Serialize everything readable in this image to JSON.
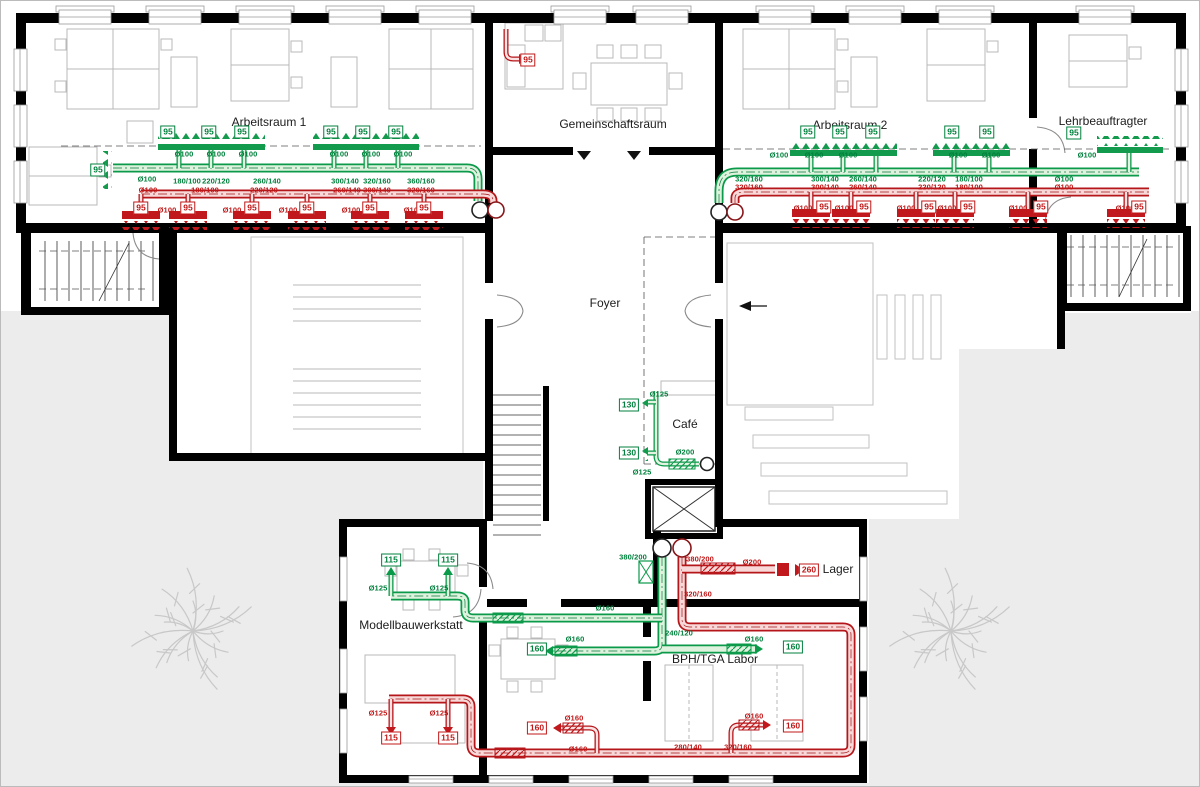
{
  "drawing": {
    "rooms": {
      "arbeitsraum_1": "Arbeitsraum 1",
      "gemeinschaftsraum": "Gemeinschaftsraum",
      "arbeitsraum_2": "Arbeitsraum 2",
      "lehrbeauftragter": "Lehrbeauftragter",
      "foyer": "Foyer",
      "cafe": "Café",
      "modellbauwerkstatt": "Modellbauwerkstatt",
      "bph_tga_labor": "BPH/TGA Labor",
      "lager": "Lager"
    },
    "colors": {
      "supply_duct": "#0b9a4a",
      "exhaust_duct": "#b5161a",
      "wall": "#000000",
      "ground": "#ececec",
      "furniture": "#b9b9b9"
    },
    "flow_badges": {
      "supply": [
        {
          "v": "95",
          "x": 97,
          "y": 169
        },
        {
          "v": "95",
          "x": 167,
          "y": 131
        },
        {
          "v": "95",
          "x": 208,
          "y": 131
        },
        {
          "v": "95",
          "x": 241,
          "y": 131
        },
        {
          "v": "95",
          "x": 330,
          "y": 131
        },
        {
          "v": "95",
          "x": 362,
          "y": 131
        },
        {
          "v": "95",
          "x": 395,
          "y": 131
        },
        {
          "v": "95",
          "x": 807,
          "y": 131
        },
        {
          "v": "95",
          "x": 839,
          "y": 131
        },
        {
          "v": "95",
          "x": 872,
          "y": 131
        },
        {
          "v": "95",
          "x": 951,
          "y": 131
        },
        {
          "v": "95",
          "x": 986,
          "y": 131
        },
        {
          "v": "95",
          "x": 1073,
          "y": 132
        },
        {
          "v": "130",
          "x": 628,
          "y": 404
        },
        {
          "v": "130",
          "x": 628,
          "y": 452
        },
        {
          "v": "115",
          "x": 390,
          "y": 559
        },
        {
          "v": "115",
          "x": 447,
          "y": 559
        },
        {
          "v": "160",
          "x": 536,
          "y": 648
        },
        {
          "v": "160",
          "x": 792,
          "y": 646
        }
      ],
      "exhaust": [
        {
          "v": "95",
          "x": 140,
          "y": 207
        },
        {
          "v": "95",
          "x": 187,
          "y": 207
        },
        {
          "v": "95",
          "x": 251,
          "y": 207
        },
        {
          "v": "95",
          "x": 306,
          "y": 207
        },
        {
          "v": "95",
          "x": 369,
          "y": 207
        },
        {
          "v": "95",
          "x": 423,
          "y": 207
        },
        {
          "v": "95",
          "x": 823,
          "y": 206
        },
        {
          "v": "95",
          "x": 863,
          "y": 206
        },
        {
          "v": "95",
          "x": 928,
          "y": 206
        },
        {
          "v": "95",
          "x": 967,
          "y": 206
        },
        {
          "v": "95",
          "x": 1040,
          "y": 206
        },
        {
          "v": "95",
          "x": 1138,
          "y": 206
        },
        {
          "v": "95",
          "x": 527,
          "y": 59
        },
        {
          "v": "115",
          "x": 390,
          "y": 737
        },
        {
          "v": "115",
          "x": 447,
          "y": 737
        },
        {
          "v": "160",
          "x": 536,
          "y": 727
        },
        {
          "v": "160",
          "x": 792,
          "y": 725
        },
        {
          "v": "260",
          "x": 808,
          "y": 569
        }
      ]
    },
    "duct_labels": {
      "supply": [
        {
          "t": "Ø100",
          "x": 183,
          "y": 153
        },
        {
          "t": "Ø100",
          "x": 215,
          "y": 153
        },
        {
          "t": "Ø100",
          "x": 247,
          "y": 153
        },
        {
          "t": "Ø100",
          "x": 338,
          "y": 153
        },
        {
          "t": "Ø100",
          "x": 370,
          "y": 153
        },
        {
          "t": "Ø100",
          "x": 402,
          "y": 153
        },
        {
          "t": "Ø100",
          "x": 146,
          "y": 178
        },
        {
          "t": "180/100",
          "x": 186,
          "y": 180
        },
        {
          "t": "220/120",
          "x": 215,
          "y": 180
        },
        {
          "t": "260/140",
          "x": 266,
          "y": 180
        },
        {
          "t": "300/140",
          "x": 344,
          "y": 180
        },
        {
          "t": "320/160",
          "x": 376,
          "y": 180
        },
        {
          "t": "360/160",
          "x": 420,
          "y": 180
        },
        {
          "t": "320/160",
          "x": 748,
          "y": 178
        },
        {
          "t": "300/140",
          "x": 824,
          "y": 178
        },
        {
          "t": "260/140",
          "x": 862,
          "y": 178
        },
        {
          "t": "220/120",
          "x": 931,
          "y": 178
        },
        {
          "t": "180/100",
          "x": 968,
          "y": 178
        },
        {
          "t": "Ø100",
          "x": 1063,
          "y": 178
        },
        {
          "t": "Ø100",
          "x": 778,
          "y": 154
        },
        {
          "t": "Ø100",
          "x": 813,
          "y": 154
        },
        {
          "t": "Ø100",
          "x": 847,
          "y": 154
        },
        {
          "t": "Ø100",
          "x": 957,
          "y": 154
        },
        {
          "t": "Ø100",
          "x": 990,
          "y": 154
        },
        {
          "t": "Ø100",
          "x": 1086,
          "y": 154
        },
        {
          "t": "Ø125",
          "x": 658,
          "y": 393
        },
        {
          "t": "Ø125",
          "x": 641,
          "y": 471
        },
        {
          "t": "Ø200",
          "x": 684,
          "y": 451
        },
        {
          "t": "380/200",
          "x": 632,
          "y": 556
        },
        {
          "t": "Ø125",
          "x": 377,
          "y": 587
        },
        {
          "t": "Ø125",
          "x": 438,
          "y": 587
        },
        {
          "t": "Ø160",
          "x": 604,
          "y": 607
        },
        {
          "t": "Ø160",
          "x": 574,
          "y": 638
        },
        {
          "t": "Ø160",
          "x": 753,
          "y": 638
        },
        {
          "t": "240/120",
          "x": 678,
          "y": 632
        }
      ],
      "exhaust": [
        {
          "t": "Ø100",
          "x": 147,
          "y": 189
        },
        {
          "t": "180/100",
          "x": 204,
          "y": 189
        },
        {
          "t": "220/120",
          "x": 263,
          "y": 189
        },
        {
          "t": "260/140",
          "x": 346,
          "y": 189
        },
        {
          "t": "300/140",
          "x": 376,
          "y": 189
        },
        {
          "t": "320/160",
          "x": 420,
          "y": 189
        },
        {
          "t": "Ø100",
          "x": 166,
          "y": 209
        },
        {
          "t": "Ø100",
          "x": 231,
          "y": 209
        },
        {
          "t": "Ø100",
          "x": 287,
          "y": 209
        },
        {
          "t": "Ø100",
          "x": 350,
          "y": 209
        },
        {
          "t": "Ø100",
          "x": 412,
          "y": 209
        },
        {
          "t": "320/160",
          "x": 748,
          "y": 186
        },
        {
          "t": "300/140",
          "x": 824,
          "y": 186
        },
        {
          "t": "260/140",
          "x": 862,
          "y": 186
        },
        {
          "t": "220/120",
          "x": 931,
          "y": 186
        },
        {
          "t": "180/100",
          "x": 968,
          "y": 186
        },
        {
          "t": "Ø100",
          "x": 1063,
          "y": 186
        },
        {
          "t": "Ø100",
          "x": 802,
          "y": 207
        },
        {
          "t": "Ø100",
          "x": 843,
          "y": 207
        },
        {
          "t": "Ø100",
          "x": 905,
          "y": 207
        },
        {
          "t": "Ø100",
          "x": 946,
          "y": 207
        },
        {
          "t": "Ø100",
          "x": 1017,
          "y": 207
        },
        {
          "t": "Ø100",
          "x": 1124,
          "y": 207
        },
        {
          "t": "380/200",
          "x": 699,
          "y": 558
        },
        {
          "t": "Ø200",
          "x": 751,
          "y": 561
        },
        {
          "t": "320/160",
          "x": 697,
          "y": 593
        },
        {
          "t": "Ø125",
          "x": 377,
          "y": 712
        },
        {
          "t": "Ø125",
          "x": 438,
          "y": 712
        },
        {
          "t": "Ø160",
          "x": 573,
          "y": 717
        },
        {
          "t": "Ø160",
          "x": 577,
          "y": 748
        },
        {
          "t": "Ø160",
          "x": 753,
          "y": 715
        },
        {
          "t": "280/140",
          "x": 687,
          "y": 746
        },
        {
          "t": "320/160",
          "x": 737,
          "y": 746
        }
      ]
    }
  }
}
